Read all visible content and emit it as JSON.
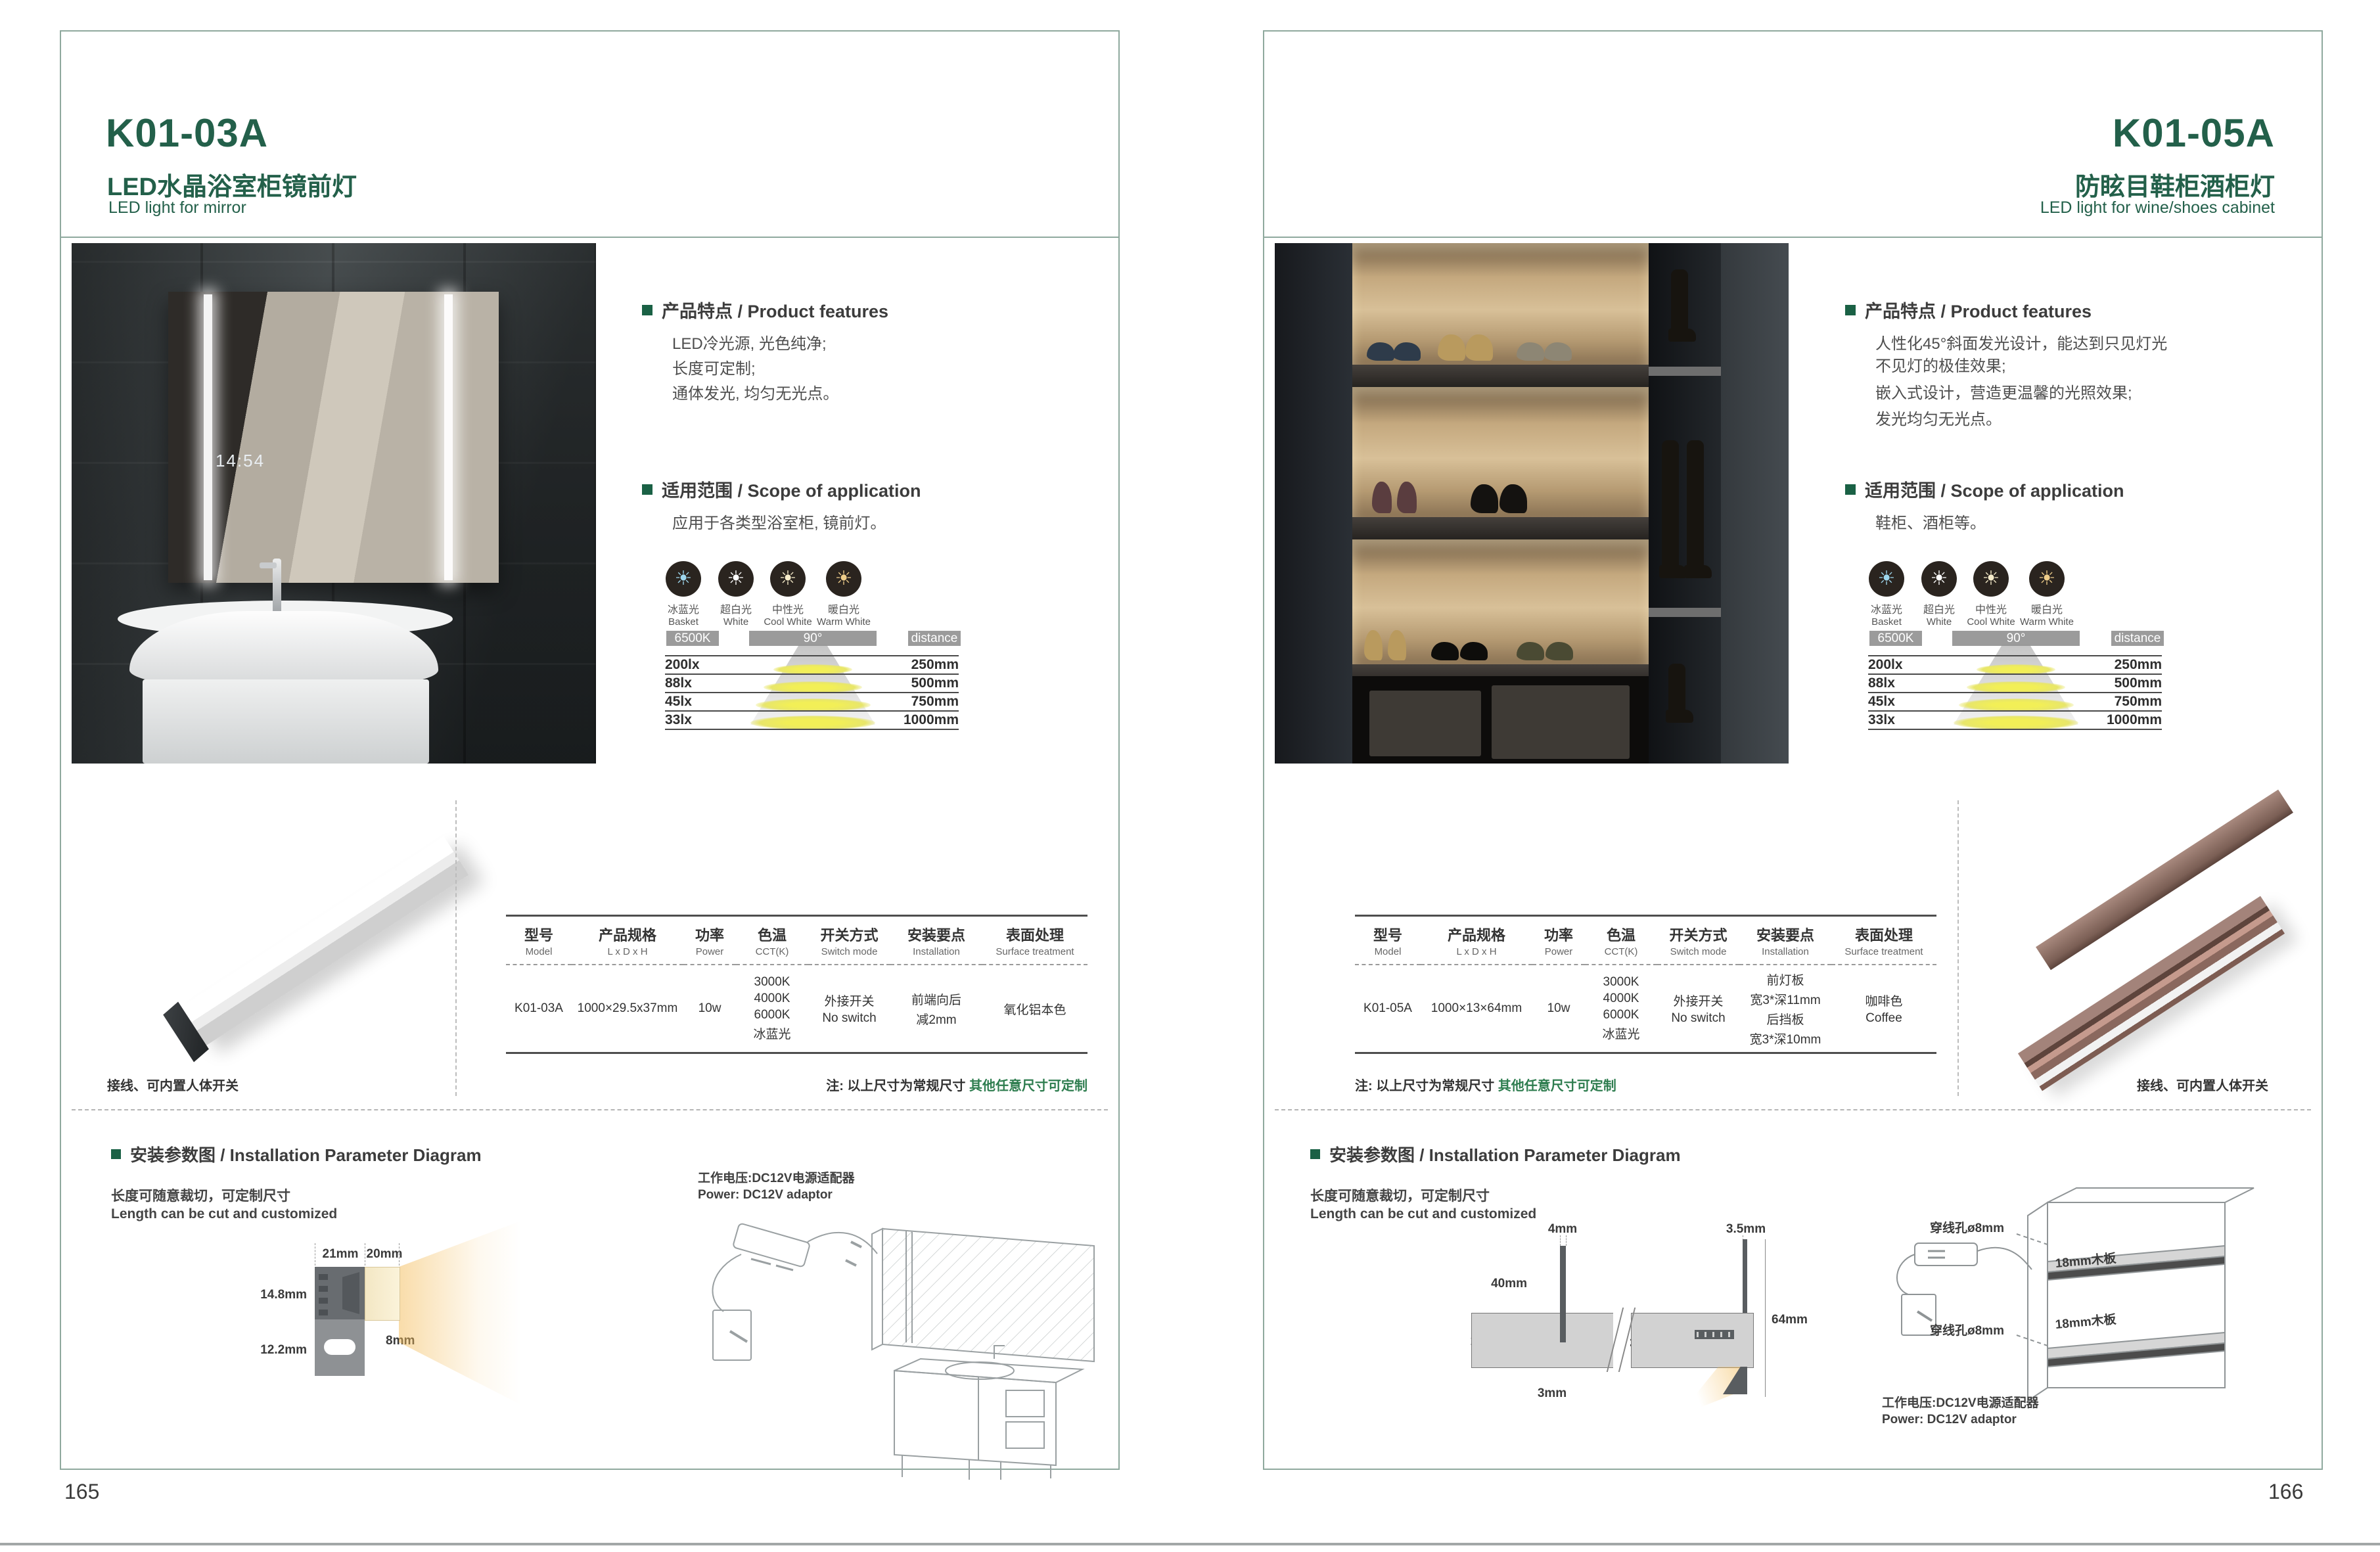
{
  "shared": {
    "accent_green": "#23604a",
    "features_heading": "产品特点 / Product features",
    "scope_heading": "适用范围 / Scope of application",
    "install_heading": "安装参数图 / Installation Parameter Diagram",
    "length_note_cn": "长度可随意裁切，可定制尺寸",
    "length_note_en": "Length can be cut and customized",
    "power_note_cn": "工作电压:DC12V电源适配器",
    "power_note_en": "Power: DC12V adaptor",
    "wiring_note": "接线、可内置人体开关",
    "size_note_prefix": "注: 以上尺寸为常规尺寸 ",
    "size_note_custom": "其他任意尺寸可定制",
    "light_modes": [
      {
        "cn": "冰蓝光",
        "en": "Basket",
        "color": "#9ed7ee"
      },
      {
        "cn": "超白光",
        "en": "White",
        "color": "#ffffff"
      },
      {
        "cn": "中性光",
        "en": "Cool White",
        "color": "#f6ecca"
      },
      {
        "cn": "暖白光",
        "en": "Warm White",
        "color": "#eecd8a"
      }
    ],
    "beam": {
      "cct": "6500K",
      "angle": "90°",
      "distance_label": "distance",
      "rows": [
        {
          "lux": "200lx",
          "distance": "250mm"
        },
        {
          "lux": "88lx",
          "distance": "500mm"
        },
        {
          "lux": "45lx",
          "distance": "750mm"
        },
        {
          "lux": "33lx",
          "distance": "1000mm"
        }
      ]
    },
    "table_headers": [
      {
        "cn": "型号",
        "en": "Model"
      },
      {
        "cn": "产品规格",
        "en": "L x D x H"
      },
      {
        "cn": "功率",
        "en": "Power"
      },
      {
        "cn": "色温",
        "en": "CCT(K)"
      },
      {
        "cn": "开关方式",
        "en": "Switch mode"
      },
      {
        "cn": "安装要点",
        "en": "Installation"
      },
      {
        "cn": "表面处理",
        "en": "Surface treatment"
      }
    ]
  },
  "page_left": {
    "model": "K01-03A",
    "title_cn": "LED水晶浴室柜镜前灯",
    "title_en": "LED light for mirror",
    "page_number": "165",
    "features": [
      "LED冷光源, 光色纯净;",
      "长度可定制;",
      "通体发光, 均匀无光点。"
    ],
    "scope_text": "应用于各类型浴室柜, 镜前灯。",
    "photo": {
      "clock": "14:54"
    },
    "spec": {
      "model": "K01-03A",
      "size": "1000×29.5x37mm",
      "power": "10w",
      "cct": [
        "3000K",
        "4000K",
        "6000K",
        "冰蓝光"
      ],
      "switch_mode": [
        "外接开关",
        "No switch"
      ],
      "installation": [
        "前端向后",
        "减2mm"
      ],
      "surface": [
        "氧化铝本色"
      ]
    },
    "dims": {
      "w21": "21mm",
      "w20": "20mm",
      "h148": "14.8mm",
      "h122": "12.2mm",
      "h8": "8mm"
    }
  },
  "page_right": {
    "model": "K01-05A",
    "title_cn": "防眩目鞋柜酒柜灯",
    "title_en": "LED light for wine/shoes cabinet",
    "page_number": "166",
    "features": [
      "人性化45°斜面发光设计，能达到只见灯光",
      "不见灯的极佳效果;",
      "嵌入式设计，营造更温馨的光照效果;",
      "发光均匀无光点。"
    ],
    "scope_text": "鞋柜、酒柜等。",
    "spec": {
      "model": "K01-05A",
      "size": "1000×13×64mm",
      "power": "10w",
      "cct": [
        "3000K",
        "4000K",
        "6000K",
        "冰蓝光"
      ],
      "switch_mode": [
        "外接开关",
        "No switch"
      ],
      "installation": [
        "前灯板",
        "宽3*深11mm",
        "后挡板",
        "宽3*深10mm"
      ],
      "surface": [
        "咖啡色",
        "Coffee"
      ]
    },
    "dims": {
      "d4": "4mm",
      "d35": "3.5mm",
      "d40": "40mm",
      "board": "18mm木板",
      "d10": "10mm",
      "d3a": "3mm",
      "d11": "11mm",
      "d3b": "3mm",
      "d64": "64mm"
    },
    "cabinet": {
      "hole": "穿线孔ø8mm",
      "board": "18mm木板"
    }
  }
}
